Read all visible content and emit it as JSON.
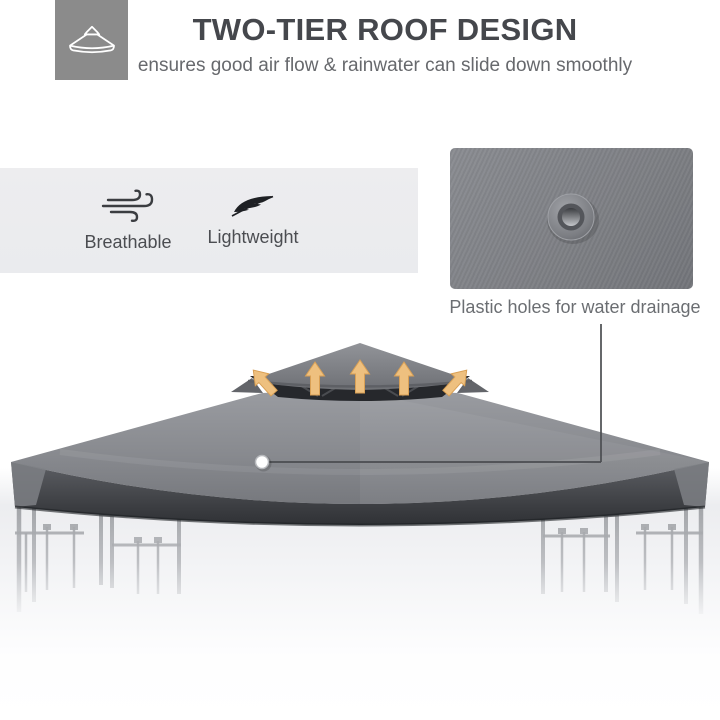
{
  "header": {
    "icon": "canopy-icon",
    "title": "TWO-TIER ROOF DESIGN",
    "subtitle": "ensures good air flow & rainwater can slide down smoothly"
  },
  "features": [
    {
      "icon": "wind-icon",
      "label": "Breathable"
    },
    {
      "icon": "feather-icon",
      "label": "Lightweight"
    }
  ],
  "callout": {
    "caption": "Plastic holes for water drainage"
  },
  "illustration": {
    "subject": "two-tier gazebo canopy roof on metal frame",
    "airflow_icons": [
      "arrow-up-icon",
      "arrow-up-icon",
      "arrow-up-icon",
      "arrow-up-left-icon",
      "arrow-up-right-icon"
    ]
  },
  "colors": {
    "header_icon_bg": "#8b8b8b",
    "title_text": "#45474c",
    "subtitle_text": "#67696d",
    "feature_panel_bg": "#ebecee",
    "canopy_gray": "#8a8c90",
    "canopy_underside": "#2b2d31",
    "airflow_arrow": "#eec07f",
    "frame_metal": "#a6a8ac",
    "callout_line": "#4b4d51"
  }
}
